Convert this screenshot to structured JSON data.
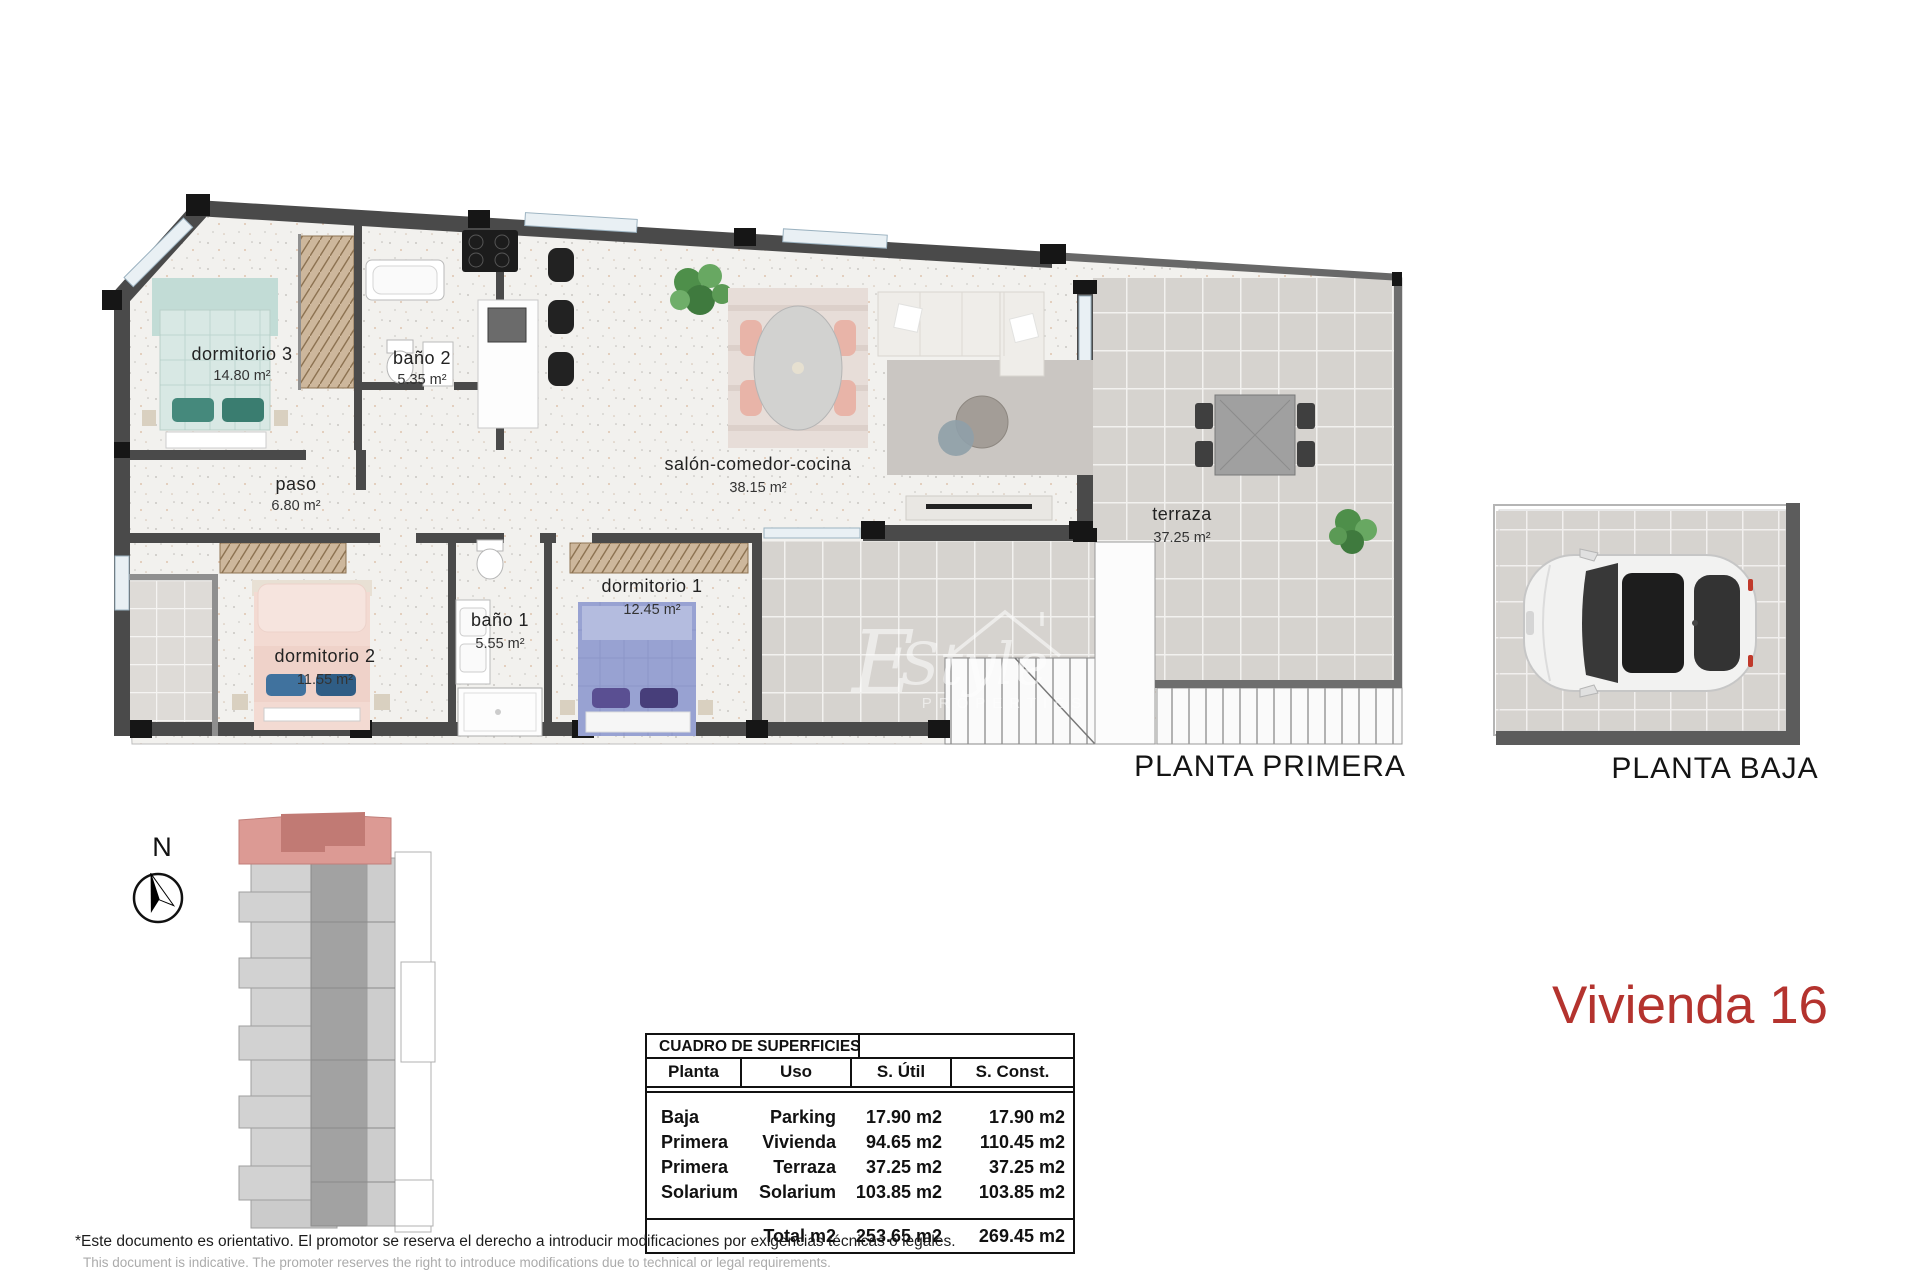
{
  "sheet": {
    "unit_title": "Vivienda 16",
    "plan_primera_label": "PLANTA PRIMERA",
    "plan_baja_label": "PLANTA BAJA",
    "compass_letter": "N"
  },
  "rooms": {
    "dormitorio3": {
      "name": "dormitorio 3",
      "area": "14.80 m²"
    },
    "bano2": {
      "name": "baño 2",
      "area": "5.35 m²"
    },
    "paso": {
      "name": "paso",
      "area": "6.80 m²"
    },
    "salon": {
      "name": "salón-comedor-cocina",
      "area": "38.15 m²"
    },
    "dormitorio2": {
      "name": "dormitorio 2",
      "area": "11.55 m²"
    },
    "bano1": {
      "name": "baño 1",
      "area": "5.55 m²"
    },
    "dormitorio1": {
      "name": "dormitorio 1",
      "area": "12.45 m²"
    },
    "terraza": {
      "name": "terraza",
      "area": "37.25 m²"
    }
  },
  "watermark": {
    "initial": "E",
    "script": "Style",
    "sub": "PROPERTIES"
  },
  "surface_table": {
    "title": "CUADRO DE SUPERFICIES",
    "columns": [
      "Planta",
      "Uso",
      "S. Útil",
      "S. Const."
    ],
    "rows": [
      [
        "Baja",
        "Parking",
        "17.90 m2",
        "17.90 m2"
      ],
      [
        "Primera",
        "Vivienda",
        "94.65 m2",
        "110.45 m2"
      ],
      [
        "Primera",
        "Terraza",
        "37.25 m2",
        "37.25 m2"
      ],
      [
        "Solarium",
        "Solarium",
        "103.85 m2",
        "103.85 m2"
      ]
    ],
    "total_label": "Total m2",
    "total_util": "253.65 m2",
    "total_const": "269.45 m2"
  },
  "footer": {
    "line_es": "*Este documento es orientativo. El promotor se reserva el derecho a introducir modificaciones por exigencias técnicas o legales.",
    "line_en": "This document is indicative. The promoter reserves the right to introduce modifications due to technical or legal requirements."
  },
  "colors": {
    "accent_red": "#b4332e",
    "wall_dark": "#4a4a4a",
    "site_highlight": "#d78d88"
  }
}
